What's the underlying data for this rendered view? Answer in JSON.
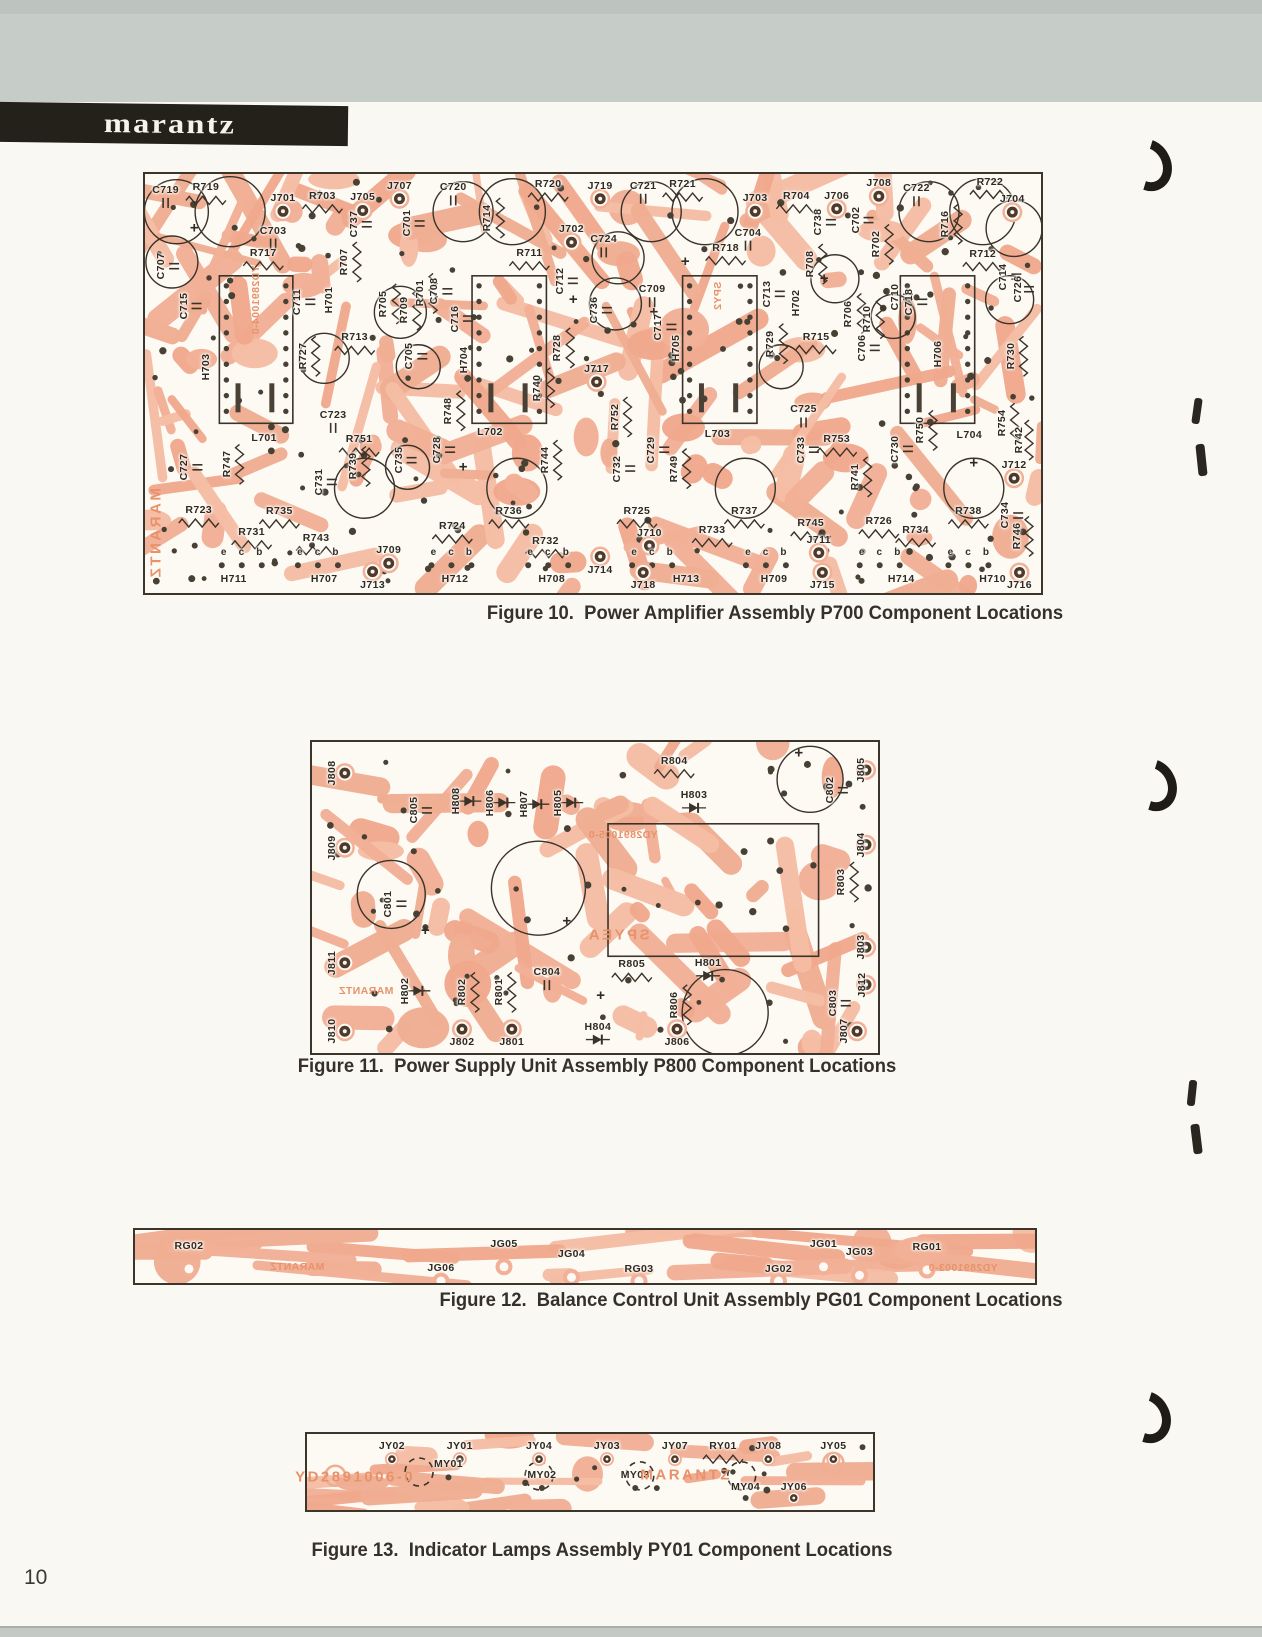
{
  "page": {
    "number": "10"
  },
  "header": {
    "brand": "marantz"
  },
  "colors": {
    "trace_salmon": "#f2b096",
    "board_white": "#fdfaf4",
    "ink_dark": "#2e2a23",
    "silk_orange": "#e8926c"
  },
  "figures": [
    {
      "id": "fig10",
      "caption": "Figure 10.  Power Amplifier Assembly P700 Component Locations",
      "labels": [
        [
          "C719",
          2.3,
          3.8,
          ""
        ],
        [
          "R719",
          6.8,
          3.2,
          ""
        ],
        [
          "J701",
          15.4,
          5.8,
          ""
        ],
        [
          "R703",
          19.8,
          5.2,
          ""
        ],
        [
          "J705",
          24.3,
          5.6,
          ""
        ],
        [
          "J707",
          28.4,
          2.8,
          ""
        ],
        [
          "C720",
          34.4,
          3.2,
          ""
        ],
        [
          "R714",
          38.2,
          10.5,
          "v"
        ],
        [
          "R720",
          45.0,
          2.4,
          ""
        ],
        [
          "J719",
          50.8,
          2.8,
          ""
        ],
        [
          "C721",
          55.6,
          2.8,
          ""
        ],
        [
          "R721",
          60.0,
          2.4,
          ""
        ],
        [
          "J703",
          68.1,
          5.8,
          ""
        ],
        [
          "R704",
          72.7,
          5.2,
          ""
        ],
        [
          "J706",
          77.2,
          5.2,
          ""
        ],
        [
          "J708",
          81.9,
          2.2,
          ""
        ],
        [
          "C722",
          86.1,
          3.4,
          ""
        ],
        [
          "R716",
          89.3,
          12.0,
          "v"
        ],
        [
          "R722",
          94.3,
          1.8,
          ""
        ],
        [
          "J704",
          96.8,
          6.0,
          ""
        ],
        [
          "C707",
          1.8,
          22.0,
          "v"
        ],
        [
          "C703",
          14.3,
          13.5,
          ""
        ],
        [
          "R717",
          13.2,
          18.8,
          ""
        ],
        [
          "C737",
          23.3,
          12.0,
          "v"
        ],
        [
          "C701",
          29.2,
          11.8,
          "v"
        ],
        [
          "R711",
          42.9,
          18.8,
          ""
        ],
        [
          "J702",
          47.6,
          13.2,
          ""
        ],
        [
          "C724",
          51.2,
          15.6,
          ""
        ],
        [
          "C712",
          46.3,
          25.5,
          "v"
        ],
        [
          "R718",
          64.8,
          17.6,
          ""
        ],
        [
          "C704",
          67.3,
          14.0,
          ""
        ],
        [
          "C738",
          75.1,
          11.5,
          "v"
        ],
        [
          "C702",
          79.3,
          11.0,
          "v"
        ],
        [
          "R702",
          81.6,
          16.8,
          "v"
        ],
        [
          "R708",
          74.2,
          21.5,
          "v"
        ],
        [
          "R712",
          93.5,
          19.0,
          ""
        ],
        [
          "C714",
          95.8,
          24.5,
          "v"
        ],
        [
          "C726",
          97.4,
          27.5,
          "v"
        ],
        [
          "C713",
          69.4,
          28.6,
          "v"
        ],
        [
          "C715",
          4.3,
          31.5,
          "v"
        ],
        [
          "H703",
          6.8,
          46.0,
          "v"
        ],
        [
          "C711",
          17.0,
          30.5,
          "v"
        ],
        [
          "H701",
          20.5,
          30.0,
          "v"
        ],
        [
          "R707",
          22.2,
          21.0,
          "v"
        ],
        [
          "R705",
          26.6,
          31.0,
          "v"
        ],
        [
          "R709",
          28.9,
          32.5,
          "v"
        ],
        [
          "R701",
          30.7,
          28.5,
          "v"
        ],
        [
          "C708",
          32.3,
          28.0,
          "v"
        ],
        [
          "R713",
          23.4,
          39.0,
          ""
        ],
        [
          "R727",
          17.6,
          43.5,
          "v"
        ],
        [
          "C705",
          29.5,
          43.5,
          "v"
        ],
        [
          "C716",
          34.6,
          34.5,
          "v"
        ],
        [
          "H704",
          35.6,
          44.5,
          "v"
        ],
        [
          "R728",
          46.0,
          41.5,
          "v"
        ],
        [
          "C736",
          50.1,
          32.5,
          "v"
        ],
        [
          "C709",
          56.6,
          27.5,
          ""
        ],
        [
          "C717",
          57.3,
          36.5,
          "v"
        ],
        [
          "H705",
          59.3,
          41.5,
          "v"
        ],
        [
          "R729",
          69.8,
          40.5,
          "v"
        ],
        [
          "H702",
          72.7,
          30.8,
          "v"
        ],
        [
          "R706",
          78.5,
          33.3,
          "v"
        ],
        [
          "R710",
          80.6,
          34.5,
          "v"
        ],
        [
          "R715",
          74.9,
          38.8,
          ""
        ],
        [
          "C706",
          80.0,
          41.5,
          "v"
        ],
        [
          "C710",
          83.7,
          29.3,
          "v"
        ],
        [
          "C718",
          85.3,
          30.5,
          "v"
        ],
        [
          "H706",
          88.5,
          43.0,
          "v"
        ],
        [
          "R730",
          96.6,
          43.5,
          "v"
        ],
        [
          "J717",
          50.4,
          46.5,
          ""
        ],
        [
          "R740",
          43.8,
          51.0,
          "v"
        ],
        [
          "R748",
          33.8,
          56.5,
          "v"
        ],
        [
          "R752",
          52.4,
          58.0,
          "v"
        ],
        [
          "R754",
          95.6,
          59.5,
          "v"
        ],
        [
          "R742",
          97.6,
          63.5,
          "v"
        ],
        [
          "L701",
          13.3,
          63.0,
          ""
        ],
        [
          "L702",
          38.5,
          61.5,
          ""
        ],
        [
          "L703",
          63.9,
          62.0,
          ""
        ],
        [
          "L704",
          92.0,
          62.2,
          ""
        ],
        [
          "C723",
          21.0,
          57.5,
          ""
        ],
        [
          "R751",
          23.9,
          63.3,
          ""
        ],
        [
          "C727",
          4.4,
          70.0,
          "v"
        ],
        [
          "R747",
          9.1,
          69.3,
          "v"
        ],
        [
          "R739",
          23.2,
          69.8,
          "v"
        ],
        [
          "C731",
          19.4,
          73.5,
          "v"
        ],
        [
          "C735",
          28.3,
          68.3,
          "v"
        ],
        [
          "C728",
          32.6,
          65.8,
          "v"
        ],
        [
          "C725",
          73.5,
          56.2,
          ""
        ],
        [
          "R753",
          77.2,
          63.3,
          ""
        ],
        [
          "C729",
          56.5,
          65.8,
          "v"
        ],
        [
          "R749",
          59.0,
          70.3,
          "v"
        ],
        [
          "C732",
          52.7,
          70.3,
          "v"
        ],
        [
          "C733",
          73.2,
          65.8,
          "v"
        ],
        [
          "R741",
          79.2,
          72.3,
          "v"
        ],
        [
          "C730",
          83.7,
          65.6,
          "v"
        ],
        [
          "R750",
          86.5,
          61.2,
          "v"
        ],
        [
          "R744",
          44.6,
          68.3,
          "v"
        ],
        [
          "J712",
          97.0,
          69.5,
          ""
        ],
        [
          "R746",
          97.3,
          86.5,
          "v"
        ],
        [
          "C734",
          96.0,
          81.5,
          "v"
        ],
        [
          "R723",
          6.0,
          80.2,
          ""
        ],
        [
          "R735",
          15.0,
          80.4,
          ""
        ],
        [
          "R731",
          11.9,
          85.4,
          ""
        ],
        [
          "R743",
          19.1,
          86.8,
          ""
        ],
        [
          "J709",
          27.2,
          89.8,
          ""
        ],
        [
          "R724",
          34.3,
          84.0,
          ""
        ],
        [
          "R736",
          40.6,
          80.4,
          ""
        ],
        [
          "R732",
          44.7,
          87.5,
          ""
        ],
        [
          "R725",
          54.9,
          80.4,
          ""
        ],
        [
          "R737",
          66.9,
          80.4,
          ""
        ],
        [
          "R733",
          63.3,
          84.9,
          ""
        ],
        [
          "R745",
          74.3,
          83.3,
          ""
        ],
        [
          "J711",
          75.2,
          87.3,
          ""
        ],
        [
          "J710",
          56.3,
          85.6,
          ""
        ],
        [
          "J714",
          50.8,
          94.4,
          ""
        ],
        [
          "R726",
          81.9,
          82.8,
          ""
        ],
        [
          "R734",
          86.0,
          84.9,
          ""
        ],
        [
          "R738",
          91.9,
          80.4,
          ""
        ],
        [
          "e    c    b",
          10.8,
          90.5,
          "p"
        ],
        [
          "e    c    b",
          19.3,
          90.5,
          "p"
        ],
        [
          "e    c    b",
          34.2,
          90.5,
          "p"
        ],
        [
          "e    c    b",
          45.0,
          90.5,
          "p"
        ],
        [
          "e    c    b",
          56.6,
          90.5,
          "p"
        ],
        [
          "e    c    b",
          69.3,
          90.5,
          "p"
        ],
        [
          "e    c    b",
          82.0,
          90.5,
          "p"
        ],
        [
          "e    c    b",
          91.9,
          90.5,
          "p"
        ],
        [
          "H711",
          9.9,
          96.6,
          ""
        ],
        [
          "H707",
          20.0,
          96.6,
          ""
        ],
        [
          "J713",
          25.4,
          98.0,
          ""
        ],
        [
          "H712",
          34.6,
          96.6,
          ""
        ],
        [
          "H708",
          45.4,
          96.6,
          ""
        ],
        [
          "J718",
          55.6,
          98.2,
          ""
        ],
        [
          "H713",
          60.4,
          96.6,
          ""
        ],
        [
          "H709",
          70.2,
          96.6,
          ""
        ],
        [
          "J715",
          75.6,
          98.2,
          ""
        ],
        [
          "H714",
          84.4,
          96.6,
          ""
        ],
        [
          "H710",
          94.6,
          96.6,
          ""
        ],
        [
          "J716",
          97.6,
          98.2,
          ""
        ],
        [
          "MARANTZ",
          1.2,
          86.0,
          "vomb"
        ],
        [
          "YD2891004-0",
          12.4,
          30.0,
          "vom"
        ],
        [
          "SPY2",
          64.0,
          29.0,
          "vom"
        ]
      ]
    },
    {
      "id": "fig11",
      "caption": "Figure 11.  Power Supply Unit Assembly P800 Component Locations",
      "labels": [
        [
          "J808",
          3.5,
          10.0,
          "v"
        ],
        [
          "J809",
          3.5,
          34.0,
          "v"
        ],
        [
          "C805",
          18.0,
          22.0,
          "v"
        ],
        [
          "H808",
          25.5,
          19.0,
          "v"
        ],
        [
          "H806",
          31.5,
          19.5,
          "v"
        ],
        [
          "H807",
          37.5,
          20.0,
          "v"
        ],
        [
          "H805",
          43.5,
          19.5,
          "v"
        ],
        [
          "R804",
          64.0,
          6.0,
          ""
        ],
        [
          "H803",
          67.5,
          17.0,
          ""
        ],
        [
          "C802",
          91.5,
          15.5,
          "v"
        ],
        [
          "J805",
          97.0,
          9.0,
          "v"
        ],
        [
          "J804",
          97.0,
          33.0,
          "v"
        ],
        [
          "R803",
          93.5,
          45.0,
          "v"
        ],
        [
          "J803",
          97.0,
          66.0,
          "v"
        ],
        [
          "C801",
          13.5,
          52.0,
          "v"
        ],
        [
          "C804",
          41.5,
          74.0,
          ""
        ],
        [
          "J811",
          3.5,
          71.0,
          "v"
        ],
        [
          "H802",
          16.5,
          80.0,
          "v"
        ],
        [
          "R802",
          26.5,
          80.5,
          "v"
        ],
        [
          "R801",
          33.0,
          80.5,
          "v"
        ],
        [
          "R805",
          56.5,
          71.5,
          ""
        ],
        [
          "H801",
          70.0,
          71.0,
          ""
        ],
        [
          "H804",
          50.5,
          91.5,
          ""
        ],
        [
          "R806",
          64.0,
          84.5,
          "v"
        ],
        [
          "C803",
          92.0,
          84.0,
          "v"
        ],
        [
          "J812",
          97.2,
          78.0,
          "v"
        ],
        [
          "J807",
          94.0,
          93.0,
          "v"
        ],
        [
          "J810",
          3.5,
          93.0,
          "v"
        ],
        [
          "J802",
          26.5,
          96.5,
          ""
        ],
        [
          "J801",
          35.3,
          96.5,
          ""
        ],
        [
          "J806",
          64.5,
          96.5,
          ""
        ],
        [
          "YD2891005-0",
          55.0,
          30.0,
          "om"
        ],
        [
          "SPYEA",
          54.0,
          62.0,
          "omb"
        ],
        [
          "MARANTZ",
          9.5,
          80.0,
          "om"
        ]
      ]
    },
    {
      "id": "fig12",
      "caption": "Figure 12.  Balance Control Unit Assembly PG01 Component Locations",
      "labels": [
        [
          "RG02",
          6.0,
          30,
          ""
        ],
        [
          "JG05",
          41.0,
          26,
          ""
        ],
        [
          "JG04",
          48.5,
          46,
          ""
        ],
        [
          "JG06",
          34.0,
          72,
          ""
        ],
        [
          "RG03",
          56.0,
          74,
          ""
        ],
        [
          "JG01",
          76.5,
          26,
          ""
        ],
        [
          "JG03",
          80.5,
          42,
          ""
        ],
        [
          "JG02",
          71.5,
          74,
          ""
        ],
        [
          "RG01",
          88.0,
          32,
          ""
        ],
        [
          "MARANTZ",
          18.0,
          70,
          "om"
        ],
        [
          "YD2891003-0",
          92.0,
          72,
          "om"
        ]
      ]
    },
    {
      "id": "fig13",
      "caption": "Figure 13.  Indicator Lamps Assembly PY01 Component Locations",
      "labels": [
        [
          "JY02",
          15.0,
          16,
          ""
        ],
        [
          "JY01",
          27.0,
          16,
          ""
        ],
        [
          "JY04",
          41.0,
          16,
          ""
        ],
        [
          "JY03",
          53.0,
          16,
          ""
        ],
        [
          "JY07",
          65.0,
          16,
          ""
        ],
        [
          "RY01",
          73.5,
          16,
          ""
        ],
        [
          "JY08",
          81.5,
          16,
          ""
        ],
        [
          "JY05",
          93.0,
          16,
          ""
        ],
        [
          "MY01",
          25.0,
          40,
          ""
        ],
        [
          "MY02",
          41.5,
          54,
          ""
        ],
        [
          "MY03",
          58.0,
          54,
          ""
        ],
        [
          "MY04",
          77.5,
          70,
          ""
        ],
        [
          "JY06",
          86.0,
          70,
          ""
        ],
        [
          "YD2891006-0",
          8.5,
          56,
          "ob"
        ],
        [
          "MARANTZ",
          67.0,
          54,
          "ob"
        ]
      ]
    }
  ]
}
